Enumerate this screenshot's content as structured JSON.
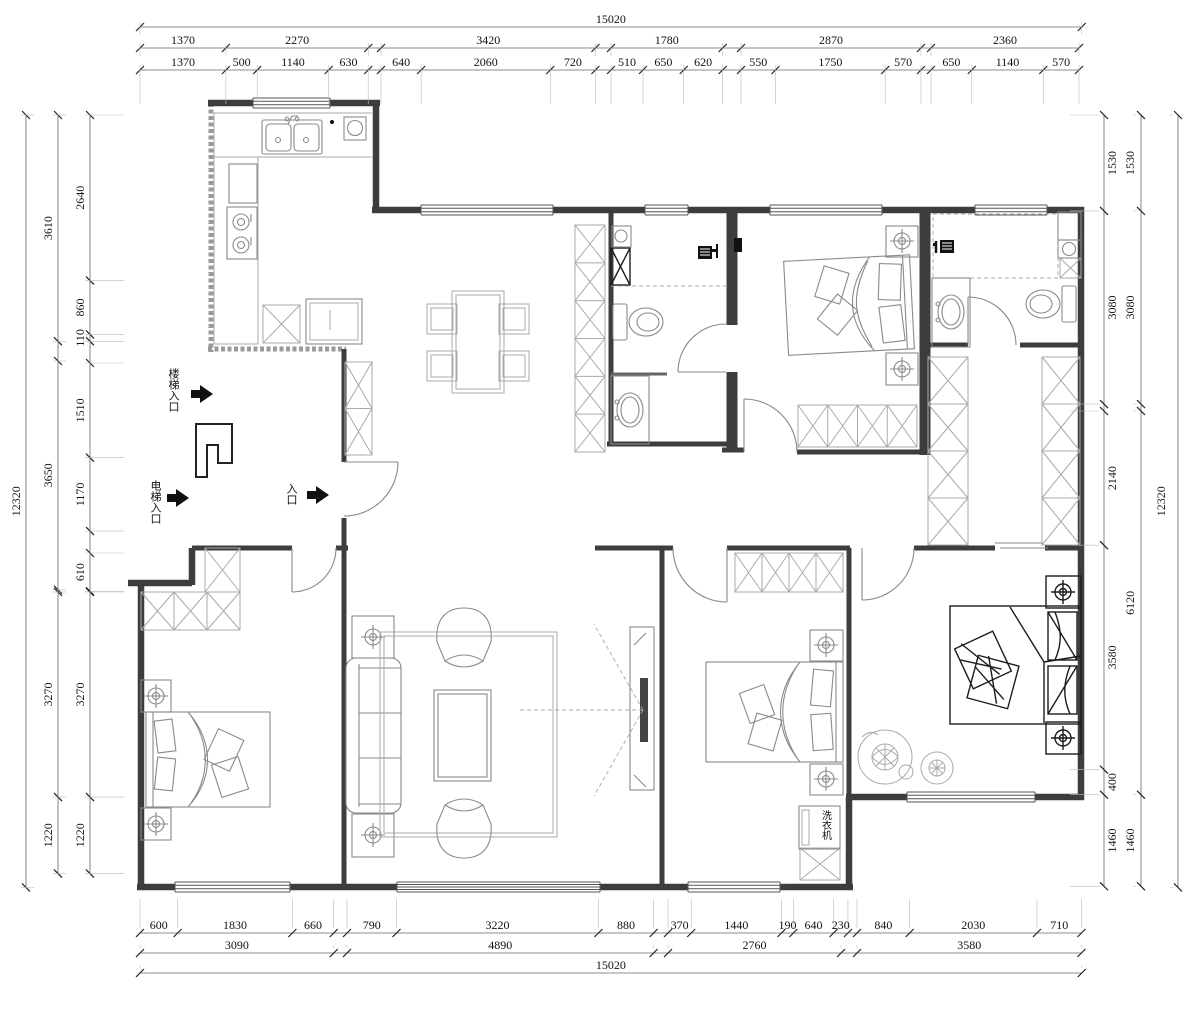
{
  "dimensions": {
    "top": {
      "overall": [
        [
          "15020"
        ]
      ],
      "middle": [
        [
          "1370",
          "2270"
        ],
        [
          "3420"
        ],
        [
          "1780"
        ],
        [
          "2870"
        ],
        [
          "2360"
        ]
      ],
      "detail": [
        [
          "1370",
          "500",
          "1140",
          "630"
        ],
        [
          "640",
          "2060",
          "720"
        ],
        [
          "510",
          "650",
          "620"
        ],
        [
          "550",
          "1750",
          "570"
        ],
        [
          "650",
          "1140",
          "570"
        ]
      ]
    },
    "bottom": {
      "detail": [
        [
          "600",
          "1830",
          "660"
        ],
        [
          "790",
          "3220",
          "880"
        ],
        [
          "370",
          "1440",
          "190",
          "640",
          "230"
        ],
        [
          "840",
          "2030",
          "710"
        ]
      ],
      "middle": [
        [
          "3090"
        ],
        [
          "4890"
        ],
        [
          "2760"
        ],
        [
          "3580"
        ]
      ],
      "overall": [
        [
          "15020"
        ]
      ]
    },
    "left": {
      "overall": [
        [
          "12320"
        ]
      ],
      "middle": [
        [
          "3610"
        ],
        [
          "3650"
        ],
        [
          "3270",
          "1220"
        ]
      ],
      "detail": [
        [
          "2640",
          "860",
          "110"
        ],
        [
          "1510",
          "1170"
        ],
        [
          "610"
        ],
        [
          "3270",
          "1220"
        ]
      ]
    },
    "right": {
      "overall": [
        [
          "12320"
        ]
      ],
      "middle": [
        [
          "1530",
          "3080"
        ],
        [
          "6120",
          "1460"
        ]
      ],
      "detail": [
        [
          "1530",
          "3080"
        ],
        [
          "2140",
          "3580",
          "400",
          "1460"
        ]
      ]
    }
  },
  "annotations": {
    "stair_entrance": "楼梯入口",
    "elevator_entrance": "电梯入口",
    "entrance": "入口",
    "washing_machine": "洗衣机"
  },
  "colors": {
    "wall": "#3d3d3d",
    "furniture": "#8a8a8a",
    "dark_furniture": "#1c1c1c",
    "background": "#ffffff",
    "dimension_text": "#111111"
  }
}
